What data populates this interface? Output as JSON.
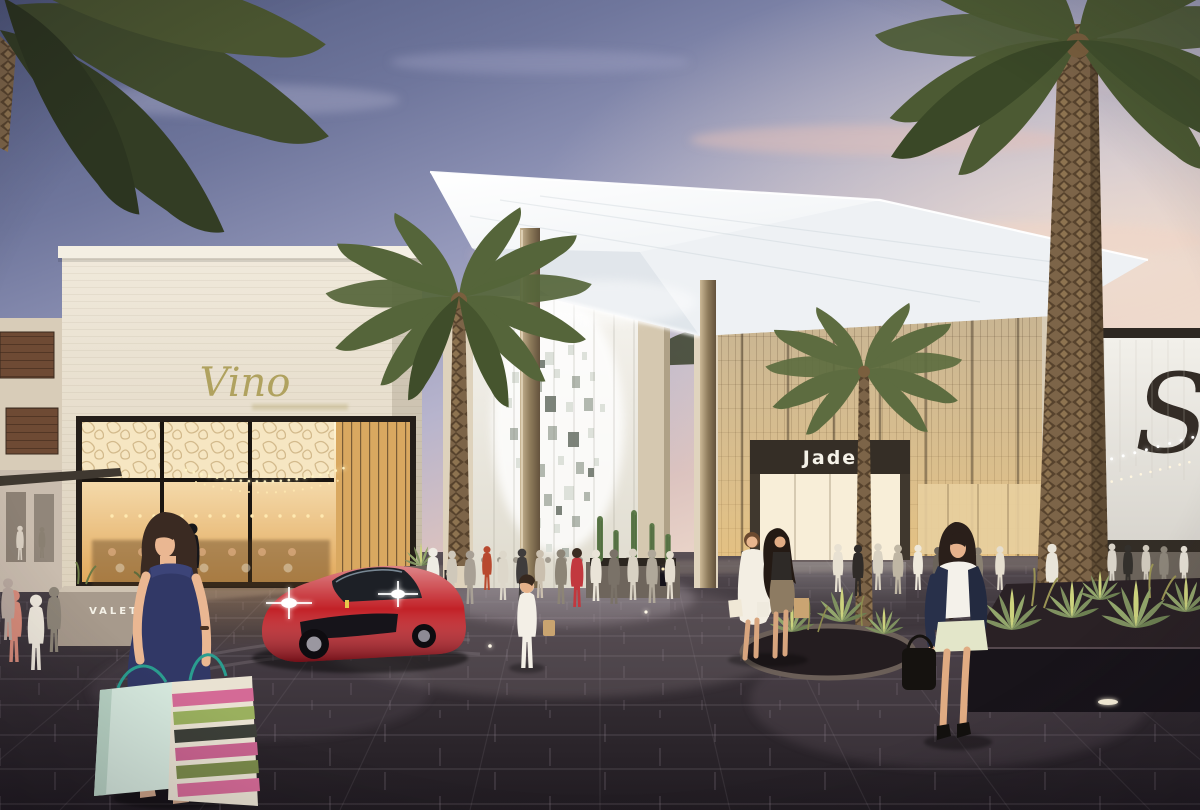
{
  "signs": {
    "vino": "Vino",
    "valet": "VALET",
    "jade": "Jade",
    "monogram": "S"
  },
  "colors": {
    "sky_top": "#50597f",
    "sky_lavender": "#b7b4cd",
    "sky_horizon": "#f0dccd",
    "canopy_white": "#f7f8fa",
    "stone": "#e7dfcf",
    "warm_glow": "#f0c070",
    "ground_dark": "#332c32",
    "car_red": "#c22127",
    "palm_green": "#57643a",
    "sign_gold": "#b0a25f",
    "sign_white": "#f5f2e8",
    "monogram_dark": "#332c26"
  }
}
